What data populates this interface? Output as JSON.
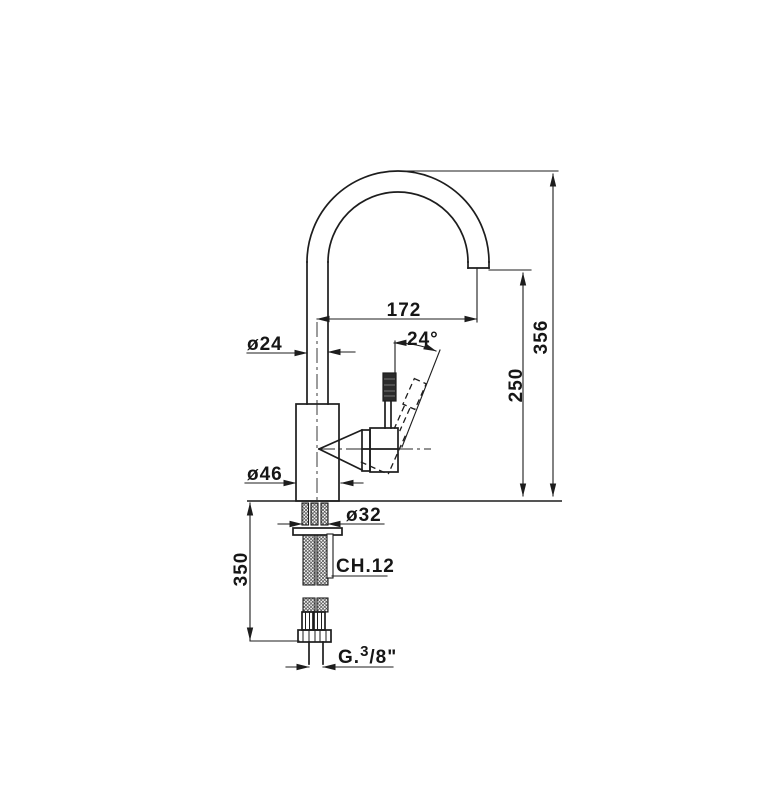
{
  "drawing": {
    "type_note": "single-lever sink mixer technical dimension drawing",
    "line_color": "#1d1d1d",
    "background_color": "#ffffff",
    "dimensions": {
      "spout_reach": "172",
      "total_height": "356",
      "outlet_height": "250",
      "under_counter_length": "350",
      "pipe_diameter": "ø24",
      "body_diameter": "ø46",
      "shank_diameter": "ø32",
      "handle_angle": "24°",
      "wrench_size": "CH.12",
      "thread": {
        "prefix": "G.",
        "num": "3",
        "den": "/8\""
      }
    }
  }
}
